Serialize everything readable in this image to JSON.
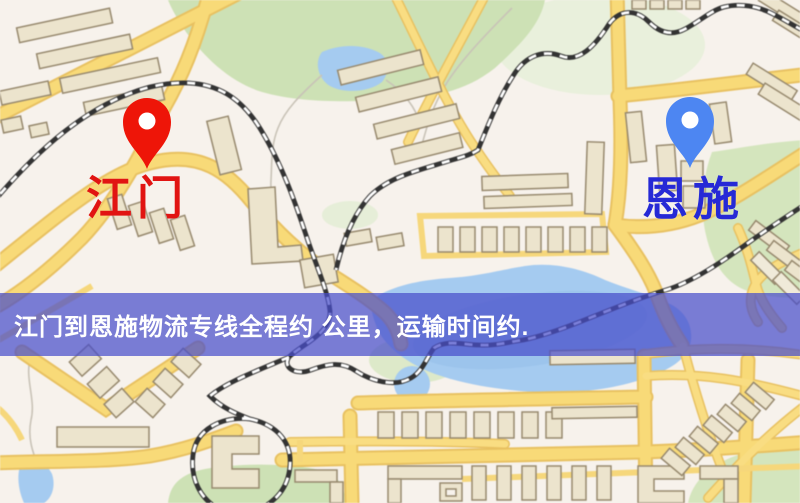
{
  "markers": [
    {
      "id": "jiangmen",
      "label": "江门",
      "pin_color": "#ee1508",
      "label_color": "#e11412"
    },
    {
      "id": "enshi",
      "label": "恩施",
      "pin_color": "#4d86f2",
      "label_color": "#2629d6"
    }
  ],
  "banner": {
    "text": "江门到恩施物流专线全程约 公里，运输时间约.",
    "background": "rgba(72,78,202,0.72)",
    "text_color": "#ffffff"
  },
  "map": {
    "type": "road-map",
    "colors": {
      "land": "#f7f2ec",
      "road": "#f8da78",
      "road_casing": "#e8c161",
      "building": "#ece4cd",
      "building_outline": "#97896e",
      "green": "#cde1b5",
      "water": "#a5cbf0",
      "railway": "#333333"
    }
  }
}
